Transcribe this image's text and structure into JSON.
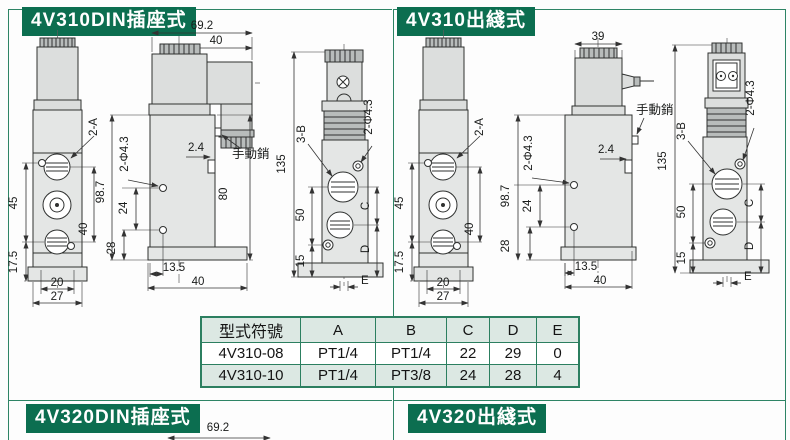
{
  "colors": {
    "tab_green": "#0c6e50",
    "frame_green": "#2e8465",
    "table_border_green": "#2c7f60",
    "row_shade": "#dce8e3"
  },
  "sections": {
    "top_left": {
      "title": "4V310DIN插座式",
      "front": {
        "ports": "2-A",
        "d45": "45",
        "d175": "17.5",
        "d40": "40",
        "d20": "20",
        "d27": "27"
      },
      "side": {
        "d692": "69.2",
        "d40t": "40",
        "d24c": "2.4",
        "pin": "手動銷",
        "d987": "98.7",
        "d24": "24",
        "d28": "28",
        "holes": "2-Φ4.3",
        "d80": "80",
        "d135": "13.5",
        "d40b": "40"
      },
      "end": {
        "d135": "135",
        "ports": "3-B",
        "d50": "50",
        "d15": "15",
        "holes": "2-Φ4.3",
        "dc": "C",
        "dd": "D",
        "de": "E"
      }
    },
    "top_right": {
      "title": "4V310出綫式",
      "front": {
        "ports": "2-A",
        "d45": "45",
        "d175": "17.5",
        "d40": "40",
        "d20": "20",
        "d27": "27"
      },
      "side": {
        "d39": "39",
        "d24c": "2.4",
        "pin": "手動銷",
        "d987": "98.7",
        "d24": "24",
        "d28": "28",
        "holes": "2-Φ4.3",
        "d135": "13.5",
        "d40b": "40"
      },
      "end": {
        "d135": "135",
        "ports": "3-B",
        "d50": "50",
        "d15": "15",
        "holes": "2-Φ4.3",
        "dc": "C",
        "dd": "D",
        "de": "E"
      }
    },
    "bottom_left": {
      "title": "4V320DIN插座式",
      "d692": "69.2"
    },
    "bottom_right": {
      "title": "4V320出綫式"
    }
  },
  "table": {
    "headers": [
      "型式符號",
      "A",
      "B",
      "C",
      "D",
      "E"
    ],
    "rows": [
      [
        "4V310-08",
        "PT1/4",
        "PT1/4",
        "22",
        "29",
        "0"
      ],
      [
        "4V310-10",
        "PT1/4",
        "PT3/8",
        "24",
        "28",
        "4"
      ]
    ]
  }
}
